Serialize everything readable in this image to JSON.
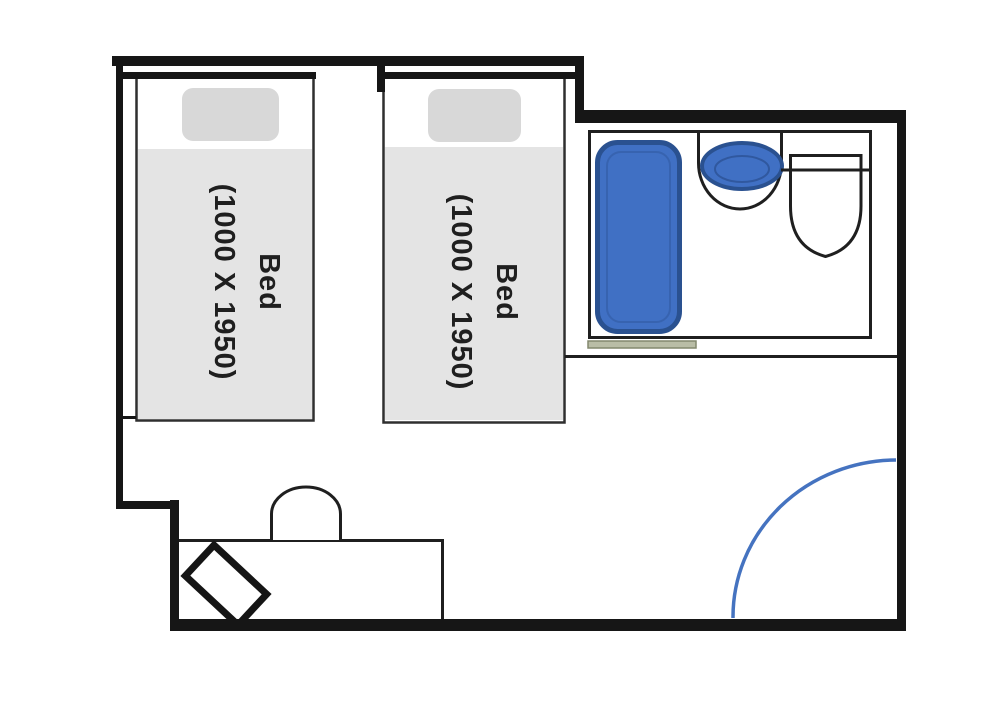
{
  "floorplan": {
    "beds": [
      {
        "line1": "Bed",
        "line2": "(1000 X 1950)"
      },
      {
        "line1": "Bed",
        "line2": "(1000 X 1950)"
      }
    ],
    "colors": {
      "wall_black": "#161616",
      "fixture_blue": "#4070c4",
      "fixture_blue_border": "#2a5190",
      "door_arc_blue": "#4573c0",
      "threshold_sage": "#b9bda6",
      "bed_blanket_gray": "#e4e4e4",
      "bed_pillow_gray": "#d8d8d8"
    },
    "fixtures": [
      "bed",
      "bed",
      "bathtub",
      "sink",
      "toilet",
      "desk",
      "chair",
      "luggage-rack",
      "door-swing-arc",
      "door-threshold"
    ]
  }
}
